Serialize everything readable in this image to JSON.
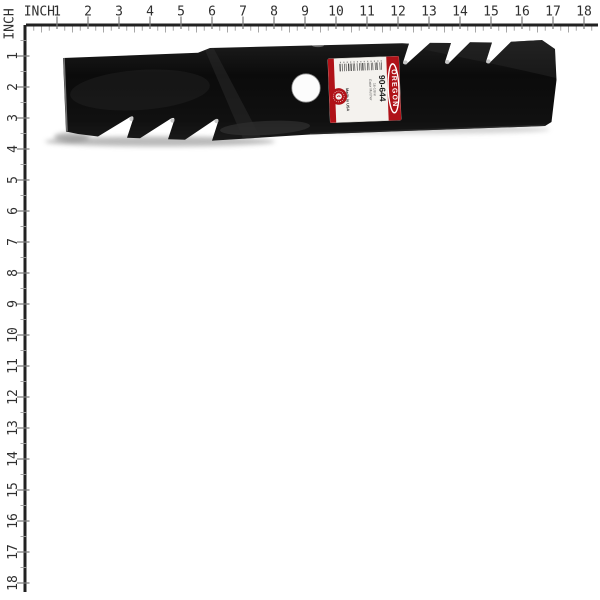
{
  "page": {
    "background": "#ffffff",
    "subject": "black gator mulcher lawn mower blade product photo with inch rulers"
  },
  "rulers": {
    "unit_label": "INCH",
    "top_numbers": [
      1,
      2,
      3,
      4,
      5,
      6,
      7,
      8,
      9,
      10,
      11,
      12,
      13,
      14,
      15,
      16,
      17,
      18
    ],
    "left_numbers": [
      1,
      2,
      3,
      4,
      5,
      6,
      7,
      8,
      9,
      10,
      11,
      12,
      13,
      14,
      15,
      16,
      17,
      18
    ],
    "line_color": "#212121",
    "major_tick_color": "#7d7d7d",
    "minor_tick_color": "#9e9e9e",
    "number_color": "#2f2f2f"
  },
  "blade": {
    "body_color": "#101010",
    "label": {
      "background": "#f4f2ee",
      "accent_red": "#b01218",
      "brand": "OREGON",
      "part_number": "90-644",
      "fine_print_line1": "16-1/8 in",
      "fine_print_line2": "Gator Mulcher",
      "origin_text": "Made in USA"
    }
  }
}
